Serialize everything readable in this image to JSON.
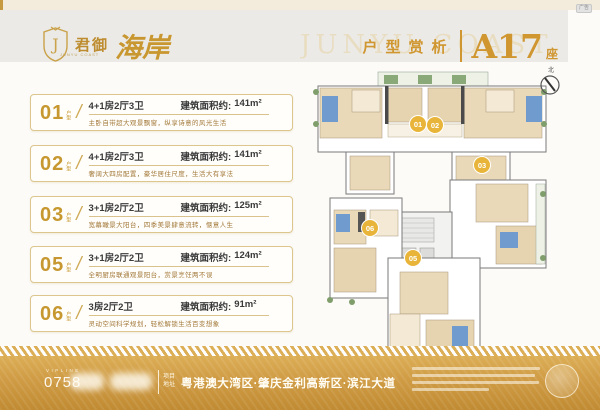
{
  "meta": {
    "ad_badge": "广告"
  },
  "colors": {
    "accent_gold": "#c6982f",
    "title_gold": "#d0962f",
    "bar_gold": "#cf9b44",
    "card_border": "#ddc68e",
    "desc_brown": "#a3793a",
    "badge_gold": "#e8b53a",
    "plan_tan": "#ead9b8",
    "plan_blue": "#6f9bcf",
    "plan_green": "#7f9e6b"
  },
  "header": {
    "brand_cn": "君御",
    "brand_script": "海岸",
    "brand_en": "JUNYU COAST",
    "watermark": "JUNYU COAST",
    "section_title": "户型赏析",
    "building": "A17",
    "building_suffix": "座"
  },
  "ui": {
    "slash": "/"
  },
  "units": [
    {
      "no": "01",
      "tag": "户型",
      "spec": "4+1房2厅3卫",
      "area_label": "建筑面积约:",
      "area": "141m²",
      "desc": "主卧自带超大观景飘窗，纵享诗意的风光生活"
    },
    {
      "no": "02",
      "tag": "户型",
      "spec": "4+1房2厅3卫",
      "area_label": "建筑面积约:",
      "area": "141m²",
      "desc": "奢阔大四房配置，豪华居住尺度，生活大有享法"
    },
    {
      "no": "03",
      "tag": "户型",
      "spec": "3+1房2厅2卫",
      "area_label": "建筑面积约:",
      "area": "125m²",
      "desc": "宽幕瞰景大阳台，四季美景肆意流转，惬意人生"
    },
    {
      "no": "05",
      "tag": "户型",
      "spec": "3+1房2厅2卫",
      "area_label": "建筑面积约:",
      "area": "124m²",
      "desc": "全明厨房联通观景阳台，赏景烹饪两不误"
    },
    {
      "no": "06",
      "tag": "户型",
      "spec": "3房2厅2卫",
      "area_label": "建筑面积约:",
      "area": "91m²",
      "desc": "灵动空间科学规划，轻松解锁生活百变想象"
    }
  ],
  "floorplan": {
    "badges": [
      "01",
      "02",
      "03",
      "06",
      "05"
    ],
    "compass_label": "北"
  },
  "footer": {
    "vip_label": "VIPLINE",
    "phone_code": "0758",
    "address_tag_line1": "项目",
    "address_tag_line2": "地址",
    "address": "粤港澳大湾区·肇庆金利高新区·滨江大道"
  }
}
